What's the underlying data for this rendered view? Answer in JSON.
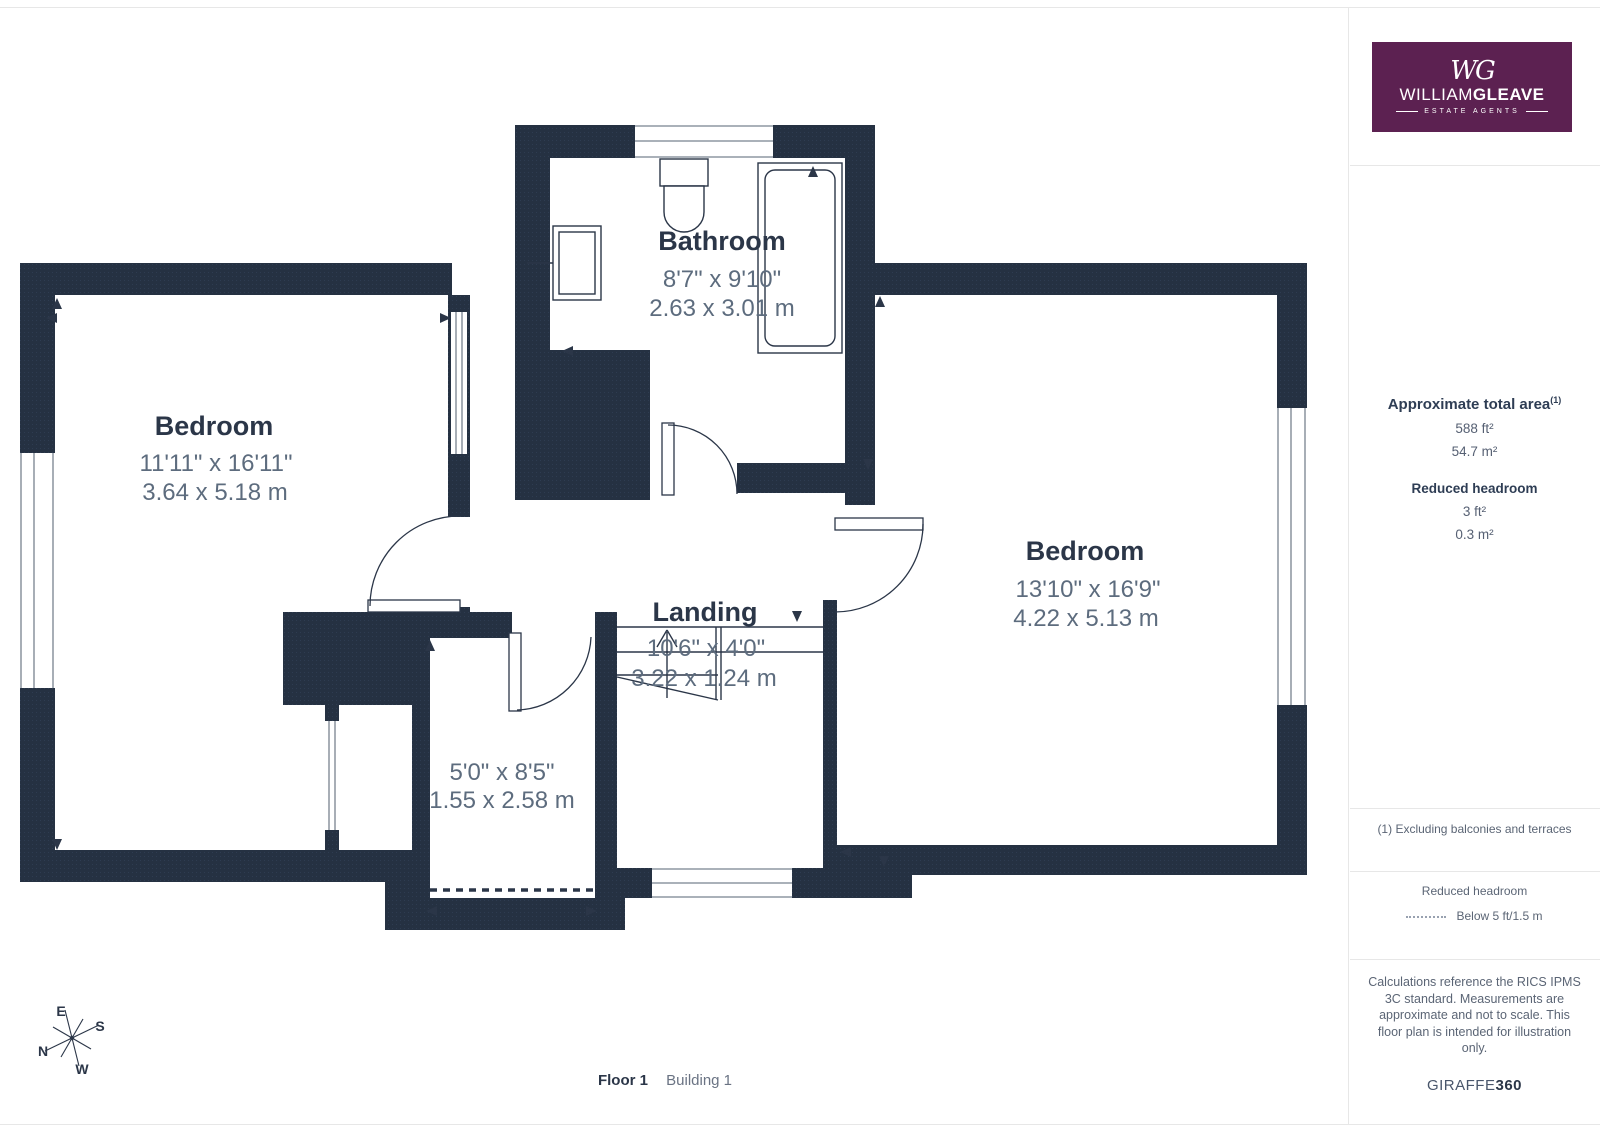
{
  "plan": {
    "rooms": [
      {
        "name": "Bedroom",
        "imperial": "11'11\" x 16'11\"",
        "metric": "3.64 x 5.18 m"
      },
      {
        "name": "Bathroom",
        "imperial": "8'7\" x 9'10\"",
        "metric": "2.63 x 3.01 m"
      },
      {
        "name": "Bedroom",
        "imperial": "13'10\" x 16'9\"",
        "metric": "4.22 x 5.13 m"
      },
      {
        "name": "Landing",
        "imperial": "10'6\" x 4'0\"",
        "metric": "3.22 x 1.24 m"
      },
      {
        "name": "",
        "imperial": "5'0\" x 8'5\"",
        "metric": "1.55 x 2.58 m"
      }
    ],
    "compass": {
      "n": "N",
      "e": "E",
      "s": "S",
      "w": "W"
    },
    "footer": {
      "floor": "Floor 1",
      "building": "Building 1"
    }
  },
  "sidebar": {
    "logo": {
      "monogram": "WG",
      "name_light": "WILLIAM",
      "name_bold": "GLEAVE",
      "tagline": "ESTATE AGENTS"
    },
    "area": {
      "title": "Approximate total area",
      "title_sup": "(1)",
      "ft": "588 ft²",
      "m": "54.7 m²"
    },
    "reduced": {
      "title": "Reduced headroom",
      "ft": "3 ft²",
      "m": "0.3 m²"
    },
    "note1": "(1) Excluding balconies and terraces",
    "legend": {
      "title": "Reduced headroom",
      "label": "Below 5 ft/1.5 m"
    },
    "disclaimer": "Calculations reference the RICS IPMS 3C standard. Measurements are approximate and not to scale. This floor plan is intended for illustration only.",
    "brand": {
      "normal": "GIRAFFE",
      "bold": "360"
    }
  },
  "colors": {
    "wall": "#253142",
    "line": "#2b3648",
    "dim_text": "#5d6c7e",
    "logo_purple": "#5c2151"
  }
}
